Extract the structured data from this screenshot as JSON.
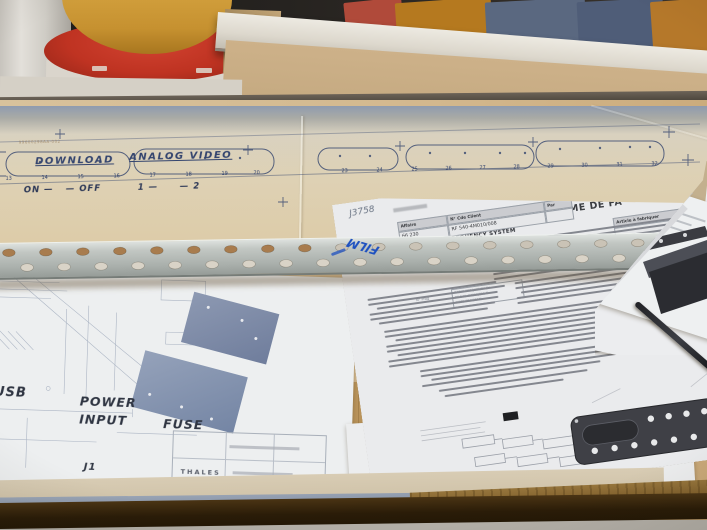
{
  "panel_drawing": {
    "part_ref": "99600298AA-002",
    "label_download": "DOWNLOAD",
    "label_analog_video": "ANALOG VIDEO",
    "switch_on": "ON —",
    "switch_off": "— OFF",
    "switch_one": "1 —",
    "switch_two": "— 2",
    "numbers": [
      "13",
      "14",
      "15",
      "16",
      "17",
      "18",
      "19",
      "20",
      "23",
      "24",
      "25",
      "26",
      "27",
      "28",
      "29",
      "30",
      "31",
      "32"
    ]
  },
  "metal_strip": {
    "marking": "FILM"
  },
  "cad_drawing": {
    "label_usb": "USB",
    "label_power": "POWER",
    "label_input": "INPUT",
    "label_fuse": "FUSE",
    "label_j1": "J1",
    "titleblock_brand": "THALES"
  },
  "routing_sheet": {
    "handwritten_ref": "J3758",
    "title": "GAMME DE FA",
    "affaire_label": "Affaire",
    "affaire_value": "66 230",
    "cde_label": "N° Cde Client",
    "cde_value": "RF 540-4M010/008",
    "par_label": "Par",
    "article_label": "Article à fabriquer",
    "qte_label": "Qté",
    "system_line": "RADIO FREQUENCY SYSTEM",
    "ref_code": "790-7017B L7",
    "note_lines": [
      "RADIO FREQUENCY SY",
      "RF 540-4M010/011 T",
      "NOTE PROGRAM"
    ],
    "n_prog_label": "N° Prog"
  },
  "convention_sheet": {
    "line1": "Nombre de Salariés exposés pour l'affaire : 1",
    "line2": "Nombre d'affaires dans la convention : 2 ( 55301 )"
  },
  "colors": {
    "marker_blue": "#1d50c0",
    "drawing_navy": "#33446e",
    "plate_blue": "#7283a2"
  }
}
